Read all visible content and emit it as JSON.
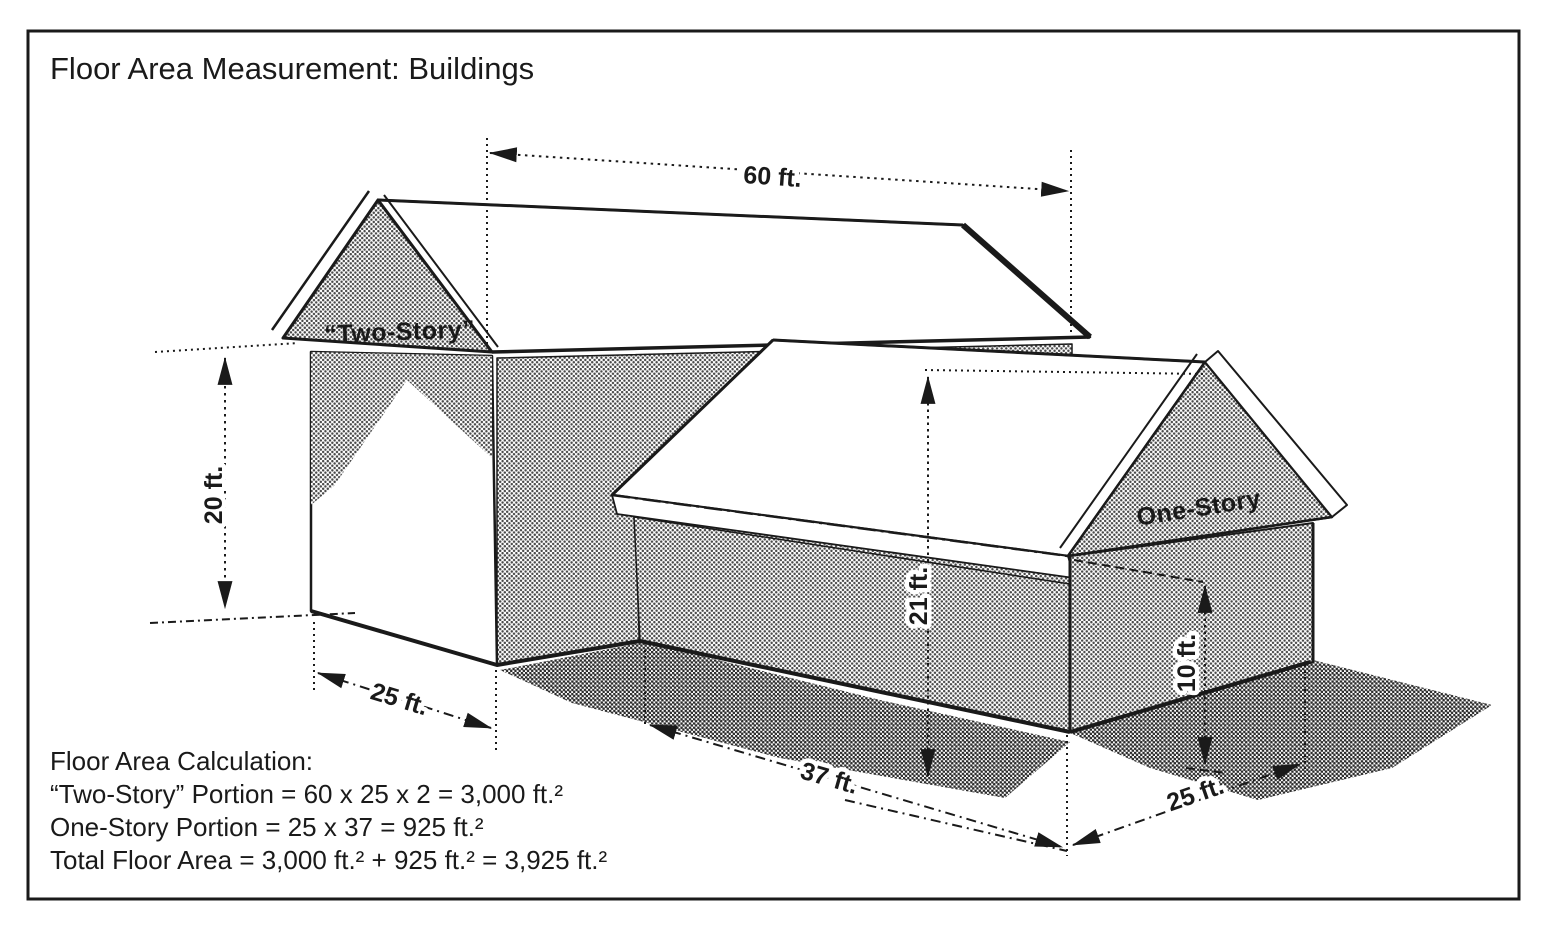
{
  "title": "Floor Area Measurement: Buildings",
  "diagram": {
    "building_labels": {
      "two_story": "“Two-Story”",
      "one_story": "One-Story"
    },
    "dimensions": {
      "d60": "60 ft.",
      "d20": "20 ft.",
      "d25_left": "25 ft.",
      "d37": "37 ft.",
      "d21": "21 ft.",
      "d10": "10 ft.",
      "d25_right": "25 ft."
    }
  },
  "calculation": {
    "heading": "Floor Area Calculation:",
    "lines": [
      "“Two-Story” Portion = 60 x 25 x 2 = 3,000 ft.²",
      "One-Story Portion = 25 x 37 = 925 ft.²",
      "Total Floor Area = 3,000 ft.² + 925 ft.² = 3,925 ft.²"
    ]
  },
  "colors": {
    "paper": "#ffffff",
    "ink": "#1a1a1a",
    "halftone_dot": "#4a4a4a",
    "shadow_dot": "#2b2b2b"
  }
}
